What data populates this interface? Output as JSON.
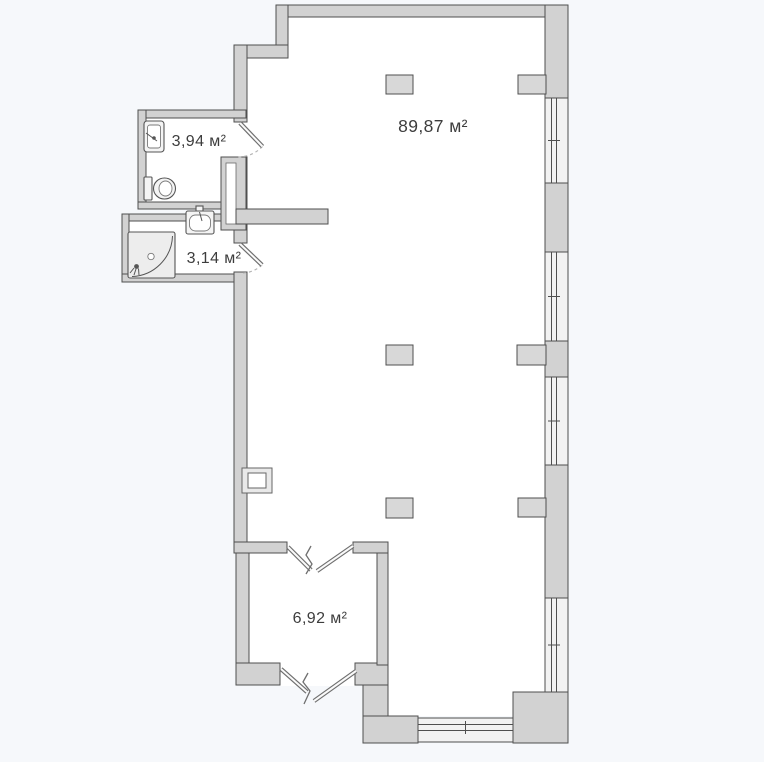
{
  "colors": {
    "background": "#f6f8fb",
    "floor": "#ffffff",
    "wall_fill": "#d2d2d2",
    "wall_stroke": "#4f4f4f",
    "pillar_fill": "#d8d8d8",
    "window_fill": "#f2f2f2",
    "fixture_fill": "#f4f4f4",
    "door_leaf": "#6f6f6f",
    "swing_arc": "#b5b5b5",
    "label_text": "#3d3d3d"
  },
  "rooms": {
    "main": {
      "area_label": "89,87 м²"
    },
    "bathroom": {
      "area_label": "3,94 м²"
    },
    "shower": {
      "area_label": "3,14 м²"
    },
    "hall": {
      "area_label": "6,92 м²"
    }
  },
  "fixtures": {
    "bathroom": [
      "sink-icon",
      "toilet-icon"
    ],
    "shower_room": [
      "washbasin-icon",
      "corner-shower-icon"
    ]
  },
  "openings": {
    "windows": 5,
    "single_doors": 2,
    "double_doors": 2
  }
}
